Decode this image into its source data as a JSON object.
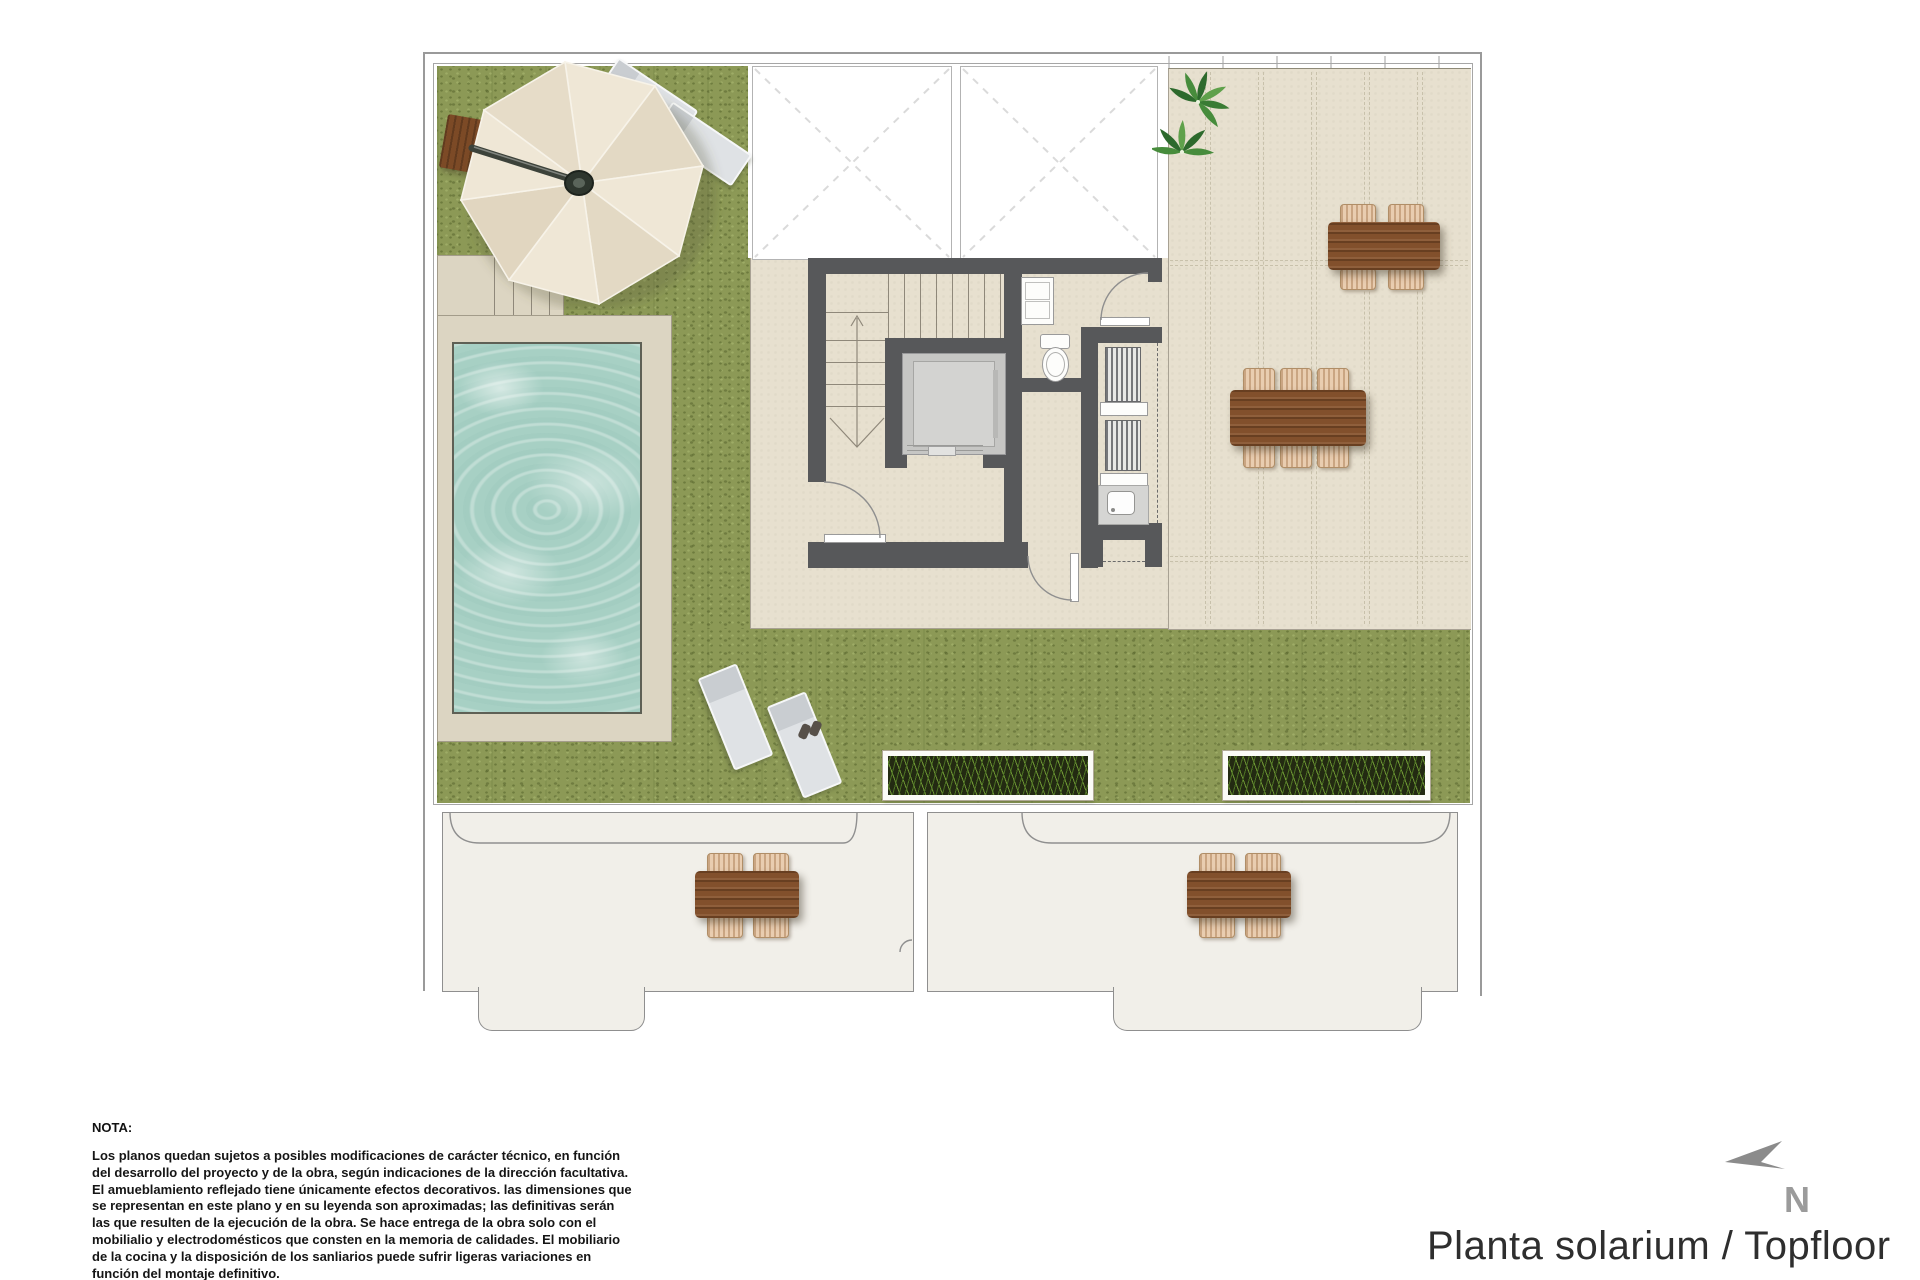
{
  "palette": {
    "grass": "#8c9956",
    "terrace": "#e7e0cf",
    "deck": "#dcd5c2",
    "pool-water": "#a7d0c4",
    "wall": "#57585a",
    "terrace-lower": "#f1efe9",
    "wood": "#82502c",
    "wicker": "#e9cdb0",
    "umbrella": "#ece4d2",
    "line": "#9a9a9a",
    "north-arrow": "#8b8b8b",
    "title-text": "#2e2e2e"
  },
  "notes": {
    "heading": "NOTA:",
    "body": "Los planos quedan sujetos a posibles modificaciones de carácter técnico, en función del desarrollo del proyecto y de la obra, según indicaciones de la dirección facultativa. El amueblamiento reflejado tiene únicamente efectos decorativos. las dimensiones que se representan en este plano y en su leyenda son aproximadas; las definitivas serán las que resulten de la ejecución de la obra. Se hace entrega de la obra solo con el mobilialio y electrodomésticos que consten en la memoria de calidades. El mobiliario de la cocina y la disposición de los sanliarios puede sufrir ligeras variaciones en función del montaje definitivo."
  },
  "titleblock": {
    "title": "Planta solarium / Topfloor"
  },
  "compass": {
    "label": "N"
  }
}
